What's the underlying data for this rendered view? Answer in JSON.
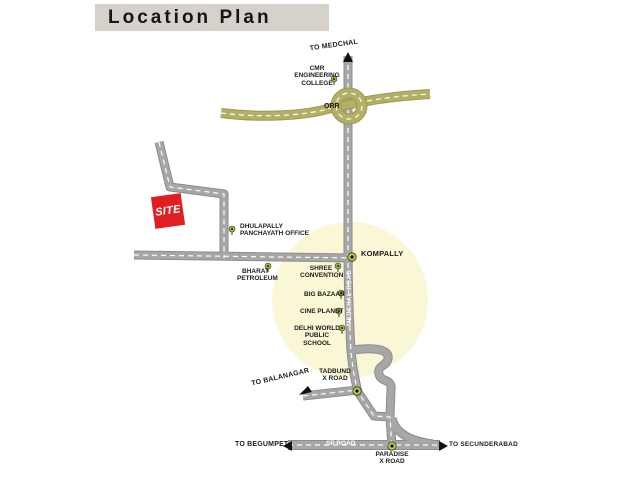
{
  "title": "Location Plan",
  "map": {
    "directions": {
      "to_medchal": "TO MEDCHAL",
      "to_balanagar": "TO BALANAGAR",
      "to_begumpet": "TO BEGUMPET",
      "to_secunderabad": "TO SECUNDERABAD"
    },
    "roads": {
      "orr": "ORR",
      "medchal_road": "MEDCHAL ROAD",
      "sp_road": "SP ROAD"
    },
    "site": "SITE",
    "junctions": {
      "kompally": "KOMPALLY",
      "tadbund": "TADBUND\nX ROAD",
      "paradise": "PARADISE\nX ROAD"
    },
    "landmarks": {
      "cmr_engineering_college": "CMR ENGINEERING\nCOLLEGE",
      "dhulapally_panchayath_office": "DHULAPALLY\nPANCHAYATH OFFICE",
      "bharat_petroleum": "BHARAT\nPETROLEUM",
      "shree_convention": "SHREE\nCONVENTION",
      "big_bazaar": "BIG BAZAAR",
      "cine_planet": "CINE PLANET",
      "delhi_world_public_school": "DELHI WORLD\nPUBLIC SCHOOL"
    },
    "colors": {
      "title_bar_bg": "#d6d2cb",
      "road_gray": "#a7a7a7",
      "road_edge": "#8c8c8c",
      "orr_olive": "#b3b065",
      "orr_edge": "#9c9950",
      "site_red": "#e01f24",
      "marker_green": "#9cbe2d",
      "junction_green": "#b5d044",
      "highlight_yellow": "#faf7d7",
      "dash_white": "#ffffff",
      "text_dark": "#1c1c1c"
    }
  }
}
